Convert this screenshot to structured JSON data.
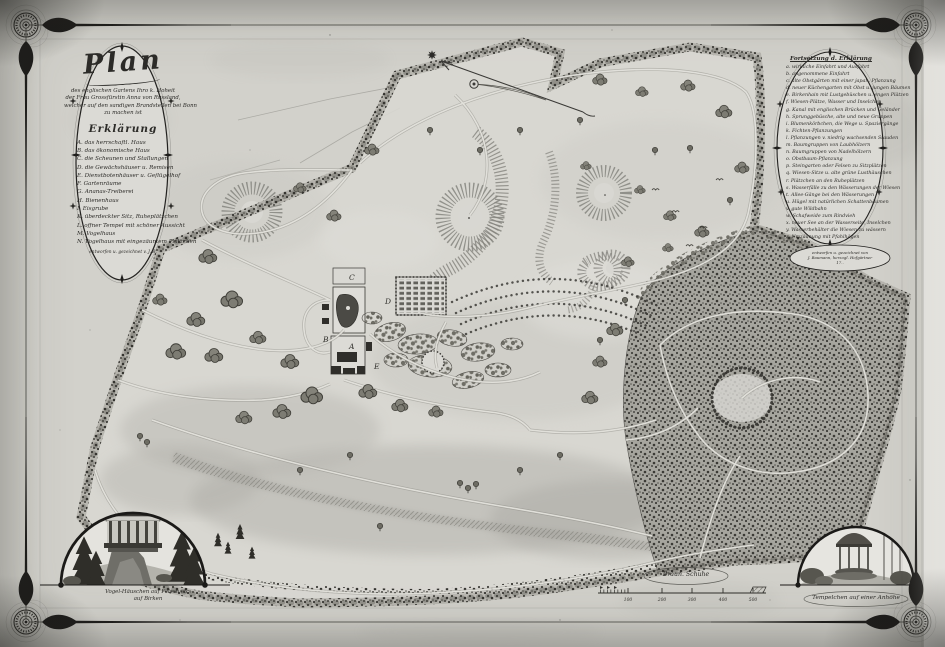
{
  "sheet": {
    "paper_color": "#d2d1cb",
    "ink_color": "#2c2b28",
    "forest_color": "#3f3e3a"
  },
  "icons": {
    "north_star": "star-burst",
    "corner_rosette": "rosette-medallion",
    "flourish_star": "small-star",
    "bead": "diamond-bead"
  },
  "title_cartouche": {
    "title": "Plan",
    "subtitle_lines": [
      "des englischen Gartens Ihro k. Hoheit",
      "der Frau Grossfürstin Anna von Russland,",
      "welcher auf den sandigen Brandstellen bei Bonn",
      "zu machen ist"
    ],
    "legend_header": "Erklärung",
    "items": [
      "A. das herrschaftl. Haus",
      "B. das ökonomische Haus",
      "C. die Scheunen und Stallungen",
      "D. die Gewächshäuser u. Remisen",
      "E. Dienstbotenhäuser u. Geflügelhof",
      "F. Gartenräume",
      "G. Ananas-Treiberei",
      "H. Bienenhaus",
      "I. Eisgrube",
      "K. überdeckter Sitz, Ruheplätzchen",
      "L. offner Tempel mit schöner Aussicht",
      "M. Vogelhaus",
      "N. Vogelhaus mit eingezäuntem Plätzchen"
    ],
    "footer": "entworfen u. gezeichnet v. J. B."
  },
  "continuation_cartouche": {
    "header": "Fortsetzung d. Erklärung",
    "items": [
      "a. wirkliche Einfahrt und Ausfahrt",
      "b. angenommene Einfahrt",
      "c. alte Obstgärten mit einer japan. Pflanzung",
      "d. neuer Küchengarten mit Obst u. jungen Bäumen",
      "e. Birkenhain mit Lustgebüschen u. engen Plätzen",
      "f. Wiesen-Plätze, Wasser und Inselchen",
      "g. Kanal mit englischen Brücken und Geländer",
      "h. Sprunggebüsche, alte und neue Gruppen",
      "i. Blumenkörbchen, die Wege u. Spaziergänge",
      "k. Fichten-Pflanzungen",
      "l. Pflanzungen v. niedrig wachsenden Stauden",
      "m. Baumgruppen von Laubhölzern",
      "n. Baumgruppen von Nadelhölzern",
      "o. Obstbaum-Pflanzung",
      "p. Steingarten oder Felsen zu Sitzplätzen",
      "q. Wiesen-Sitze u. alte grüne Lusthäuschen",
      "r. Plätzchen an den Ruheplätzen",
      "s. Wasserfälle zu den Wässerungen der Wiesen",
      "t. Allee-Gänge bei den Wässerungen",
      "u. Hügel mit natürlichen Schattenbäumen",
      "v. gute Wildbahn",
      "w. Schafweide zum Rindvieh",
      "x. neuer See an der Wasserseite, Inselchen",
      "y. Wasserbehälter die Wiesen zu wässern",
      "z. Umzäunung mit Pfahlhägen"
    ],
    "signature_lines": [
      "entworfen u. gezeichnet von",
      "J. Baumann, herzogl. Hofgärtner",
      "17.."
    ]
  },
  "vignettes": {
    "left": {
      "caption_lines": [
        "Vogel-Häuschen auf Felsen etc.",
        "auf Birken"
      ]
    },
    "right": {
      "caption": "Tempelchen auf einer Anhöhe"
    }
  },
  "scale_bar": {
    "label": "Braun. Schuhe",
    "ticks": [
      "100",
      "200",
      "300",
      "400",
      "500"
    ]
  },
  "map_letters": [
    {
      "char": "C"
    },
    {
      "char": "D"
    },
    {
      "char": "A"
    },
    {
      "char": "B"
    },
    {
      "char": "E"
    }
  ]
}
